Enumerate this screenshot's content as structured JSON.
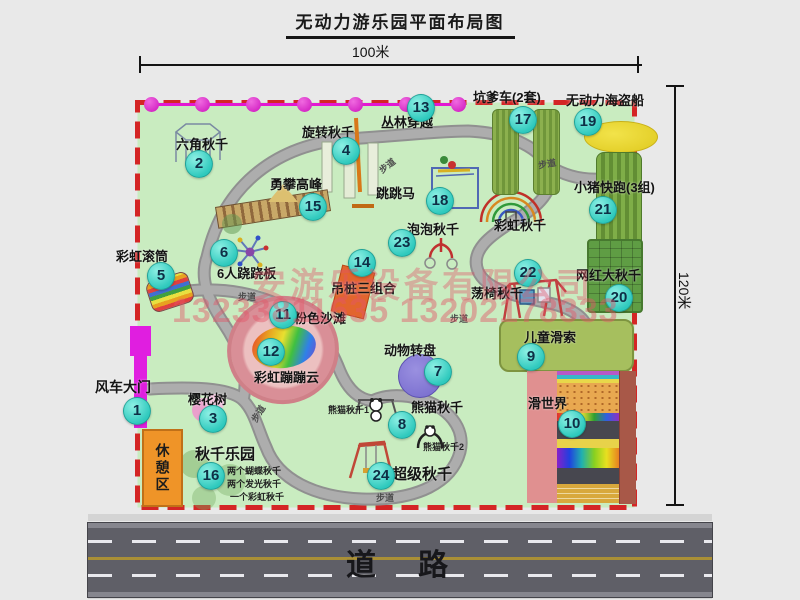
{
  "title": "无动力游乐园平面布局图",
  "dimensions": {
    "top": "100米",
    "right": "120米"
  },
  "road": {
    "label": "道　路"
  },
  "watermark": {
    "company": "安游乐设备有限公司",
    "phones": "13233811635 13202178333"
  },
  "rest_area": {
    "label": "休憩区"
  },
  "map": {
    "border_color": "#d42525",
    "ground_color": "#c9ecc0",
    "badge_color": "#2ec9bd",
    "walkway_label_text": "步道",
    "walkway_labels": [
      {
        "x": 378,
        "y": 159,
        "r": -38
      },
      {
        "x": 538,
        "y": 157,
        "r": -10
      },
      {
        "x": 238,
        "y": 290,
        "r": 0
      },
      {
        "x": 249,
        "y": 407,
        "r": -58
      },
      {
        "x": 450,
        "y": 312,
        "r": 0
      },
      {
        "x": 376,
        "y": 491,
        "r": 0
      }
    ],
    "items": [
      {
        "num": "1",
        "label": "风车大门",
        "badge": [
          136,
          410
        ],
        "label_pos": [
          95,
          377
        ],
        "size": 14
      },
      {
        "num": "2",
        "label": "六角秋千",
        "badge": [
          198,
          163
        ],
        "label_pos": [
          176,
          134
        ]
      },
      {
        "num": "3",
        "label": "樱花树",
        "badge": [
          212,
          418
        ],
        "label_pos": [
          188,
          389
        ]
      },
      {
        "num": "4",
        "label": "旋转秋千",
        "badge": [
          345,
          150
        ],
        "label_pos": [
          302,
          122
        ]
      },
      {
        "num": "5",
        "label": "彩虹滚筒",
        "badge": [
          160,
          275
        ],
        "label_pos": [
          116,
          246
        ]
      },
      {
        "num": "6",
        "label": "6人跷跷板",
        "badge": [
          223,
          252
        ],
        "label_pos": [
          217,
          263
        ]
      },
      {
        "num": "7",
        "label": "动物转盘",
        "badge": [
          437,
          371
        ],
        "label_pos": [
          384,
          340
        ]
      },
      {
        "num": "8",
        "label": "熊猫秋千",
        "badge": [
          401,
          424
        ],
        "label_pos": [
          411,
          397
        ],
        "subs": [
          {
            "t": "熊猫秋千1",
            "x": 328,
            "y": 403
          },
          {
            "t": "熊猫秋千2",
            "x": 423,
            "y": 440
          }
        ]
      },
      {
        "num": "9",
        "label": "儿童滑索",
        "badge": [
          530,
          356
        ],
        "label_pos": [
          524,
          327
        ]
      },
      {
        "num": "10",
        "label": "滑世界",
        "badge": [
          571,
          423
        ],
        "label_pos": [
          528,
          393
        ]
      },
      {
        "num": "11",
        "label": "粉色沙滩",
        "badge": [
          282,
          314
        ],
        "label_pos": [
          294,
          308
        ]
      },
      {
        "num": "12",
        "label": "彩虹蹦蹦云",
        "badge": [
          270,
          351
        ],
        "label_pos": [
          254,
          367
        ]
      },
      {
        "num": "13",
        "label": "丛林穿越",
        "badge": [
          420,
          107
        ],
        "label_pos": [
          381,
          112
        ]
      },
      {
        "num": "14",
        "label": "吊桩三组合",
        "badge": [
          361,
          262
        ],
        "label_pos": [
          331,
          278
        ]
      },
      {
        "num": "15",
        "label": "勇攀高峰",
        "badge": [
          312,
          206
        ],
        "label_pos": [
          270,
          174
        ]
      },
      {
        "num": "16",
        "label": "秋千乐园",
        "badge": [
          210,
          475
        ],
        "label_pos": [
          195,
          443
        ],
        "size": 15,
        "subs": [
          {
            "t": "两个蝴蝶秋千",
            "x": 227,
            "y": 464
          },
          {
            "t": "两个发光秋千",
            "x": 227,
            "y": 477
          },
          {
            "t": "一个彩虹秋千",
            "x": 230,
            "y": 490
          }
        ]
      },
      {
        "num": "17",
        "label": "坑爹车(2套)",
        "badge": [
          522,
          119
        ],
        "label_pos": [
          473,
          87
        ]
      },
      {
        "num": "18",
        "label": "跳跳马",
        "badge": [
          439,
          200
        ],
        "label_pos": [
          376,
          183
        ]
      },
      {
        "num": "19",
        "label": "无动力海盗船",
        "badge": [
          587,
          121
        ],
        "label_pos": [
          566,
          90
        ]
      },
      {
        "num": "20",
        "label": "网红大秋千",
        "badge": [
          618,
          297
        ],
        "label_pos": [
          576,
          265
        ]
      },
      {
        "num": "21",
        "label": "小猪快跑(3组)",
        "badge": [
          602,
          209
        ],
        "label_pos": [
          574,
          177
        ]
      },
      {
        "num": "22",
        "label": "荡椅秋千",
        "badge": [
          527,
          272
        ],
        "label_pos": [
          471,
          283
        ]
      },
      {
        "num": "23",
        "label": "泡泡秋千",
        "badge": [
          401,
          242
        ],
        "label_pos": [
          407,
          219
        ]
      },
      {
        "num": "24",
        "label": "超级秋千",
        "badge": [
          380,
          475
        ],
        "label_pos": [
          392,
          463
        ],
        "size": 15
      },
      {
        "num": null,
        "label": "彩虹秋千",
        "badge": null,
        "label_pos": [
          494,
          215
        ]
      }
    ]
  }
}
